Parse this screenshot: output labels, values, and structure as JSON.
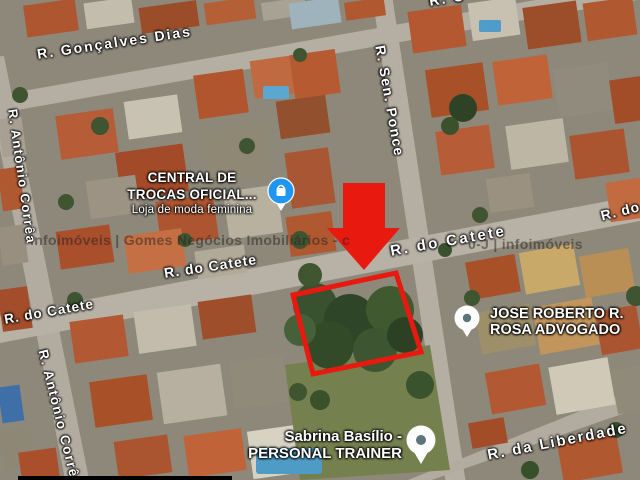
{
  "map": {
    "streets": {
      "goncalves_dias": "R. Gonçalves Dias",
      "antonio_correa_upper": "R. Antônio Corrêa",
      "antonio_correa_lower": "R. Antônio Corrêa",
      "sen_ponce": "R. Sen. Ponce",
      "catete_left": "R. do Catete",
      "catete_center": "R. do Catete",
      "catete_right": "R. do Catete",
      "catete_edge_clipped": "R. do Catete",
      "liberdade": "R. da Liberdade",
      "top_clipped": "R. C"
    },
    "places": {
      "central_trocas": {
        "line1": "CENTRAL DE",
        "line2": "TROCAS OFICIAL...",
        "subtitle": "Loja de moda feminina",
        "icon": "shopping-bag-pin"
      },
      "jose_roberto": {
        "line1": "JOSE ROBERTO R.",
        "line2": "ROSA ADVOGADO",
        "icon": "generic-place-pin"
      },
      "sabrina": {
        "line1": "Sabrina Basílio -",
        "line2": "PERSONAL TRAINER",
        "icon": "generic-place-pin"
      }
    },
    "watermark": {
      "left": "infoimóveis | Gomes Negócios Imobiliários - c",
      "right": "0-J | infoimóveis"
    },
    "colors": {
      "annotation_red": "#e8190f",
      "pin_blue": "#2096f3",
      "pin_dot": "#5b757b",
      "road": "#b5afa3"
    }
  }
}
